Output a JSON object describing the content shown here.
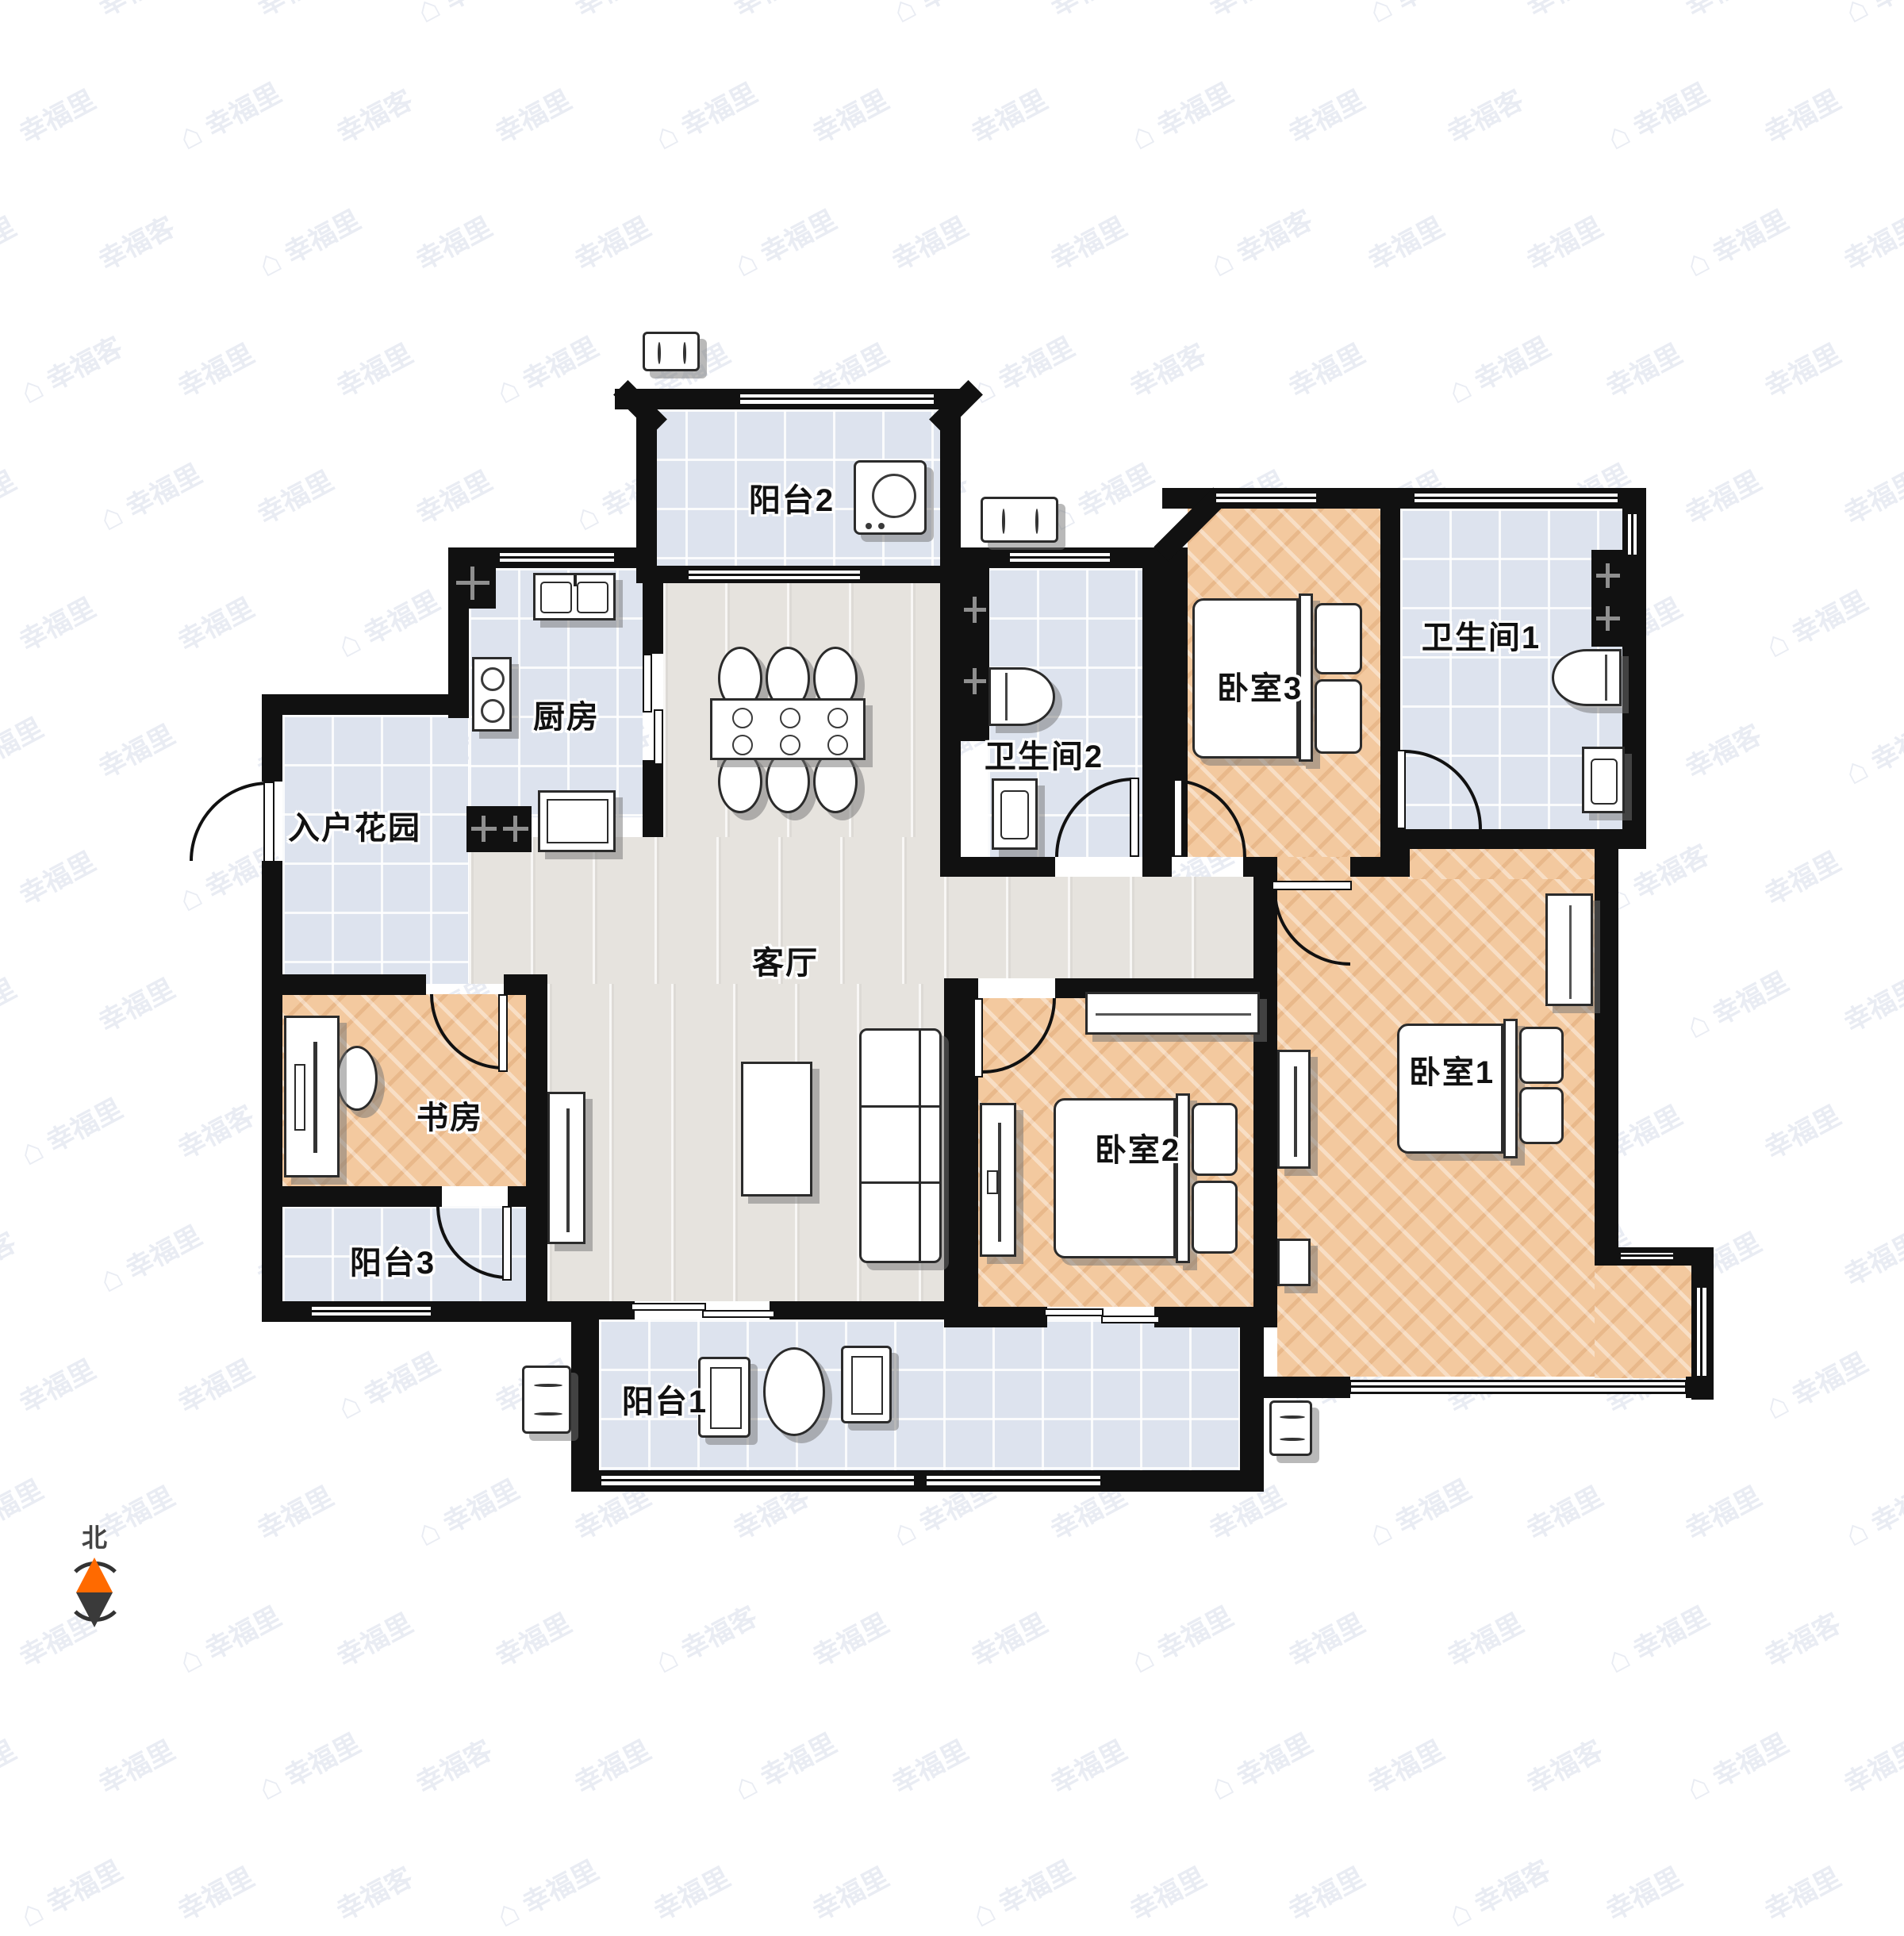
{
  "watermark": {
    "brand": "幸福里",
    "alt_brand": "幸福客",
    "house_icon": "house-icon",
    "color": "#e9ecf3"
  },
  "compass": {
    "label": "北",
    "north_color": "#ff6a00",
    "south_color": "#3a3a3a"
  },
  "rooms": {
    "balcony2": {
      "label": "阳台2"
    },
    "kitchen": {
      "label": "厨房"
    },
    "entry_garden": {
      "label": "入户花园"
    },
    "bath2": {
      "label": "卫生间2"
    },
    "bedroom3": {
      "label": "卧室3"
    },
    "bath1": {
      "label": "卫生间1"
    },
    "living": {
      "label": "客厅"
    },
    "study": {
      "label": "书房"
    },
    "balcony3": {
      "label": "阳台3"
    },
    "bedroom2": {
      "label": "卧室2"
    },
    "bedroom1": {
      "label": "卧室1"
    },
    "balcony1": {
      "label": "阳台1"
    }
  },
  "colors": {
    "wall": "#111111",
    "tile_floor": "#dde3ee",
    "gray_wood_floor": "#e6e3de",
    "warm_wood_floor": "#f3c99f",
    "furniture_outline": "#2b2b2b",
    "shadow": "#737373"
  }
}
